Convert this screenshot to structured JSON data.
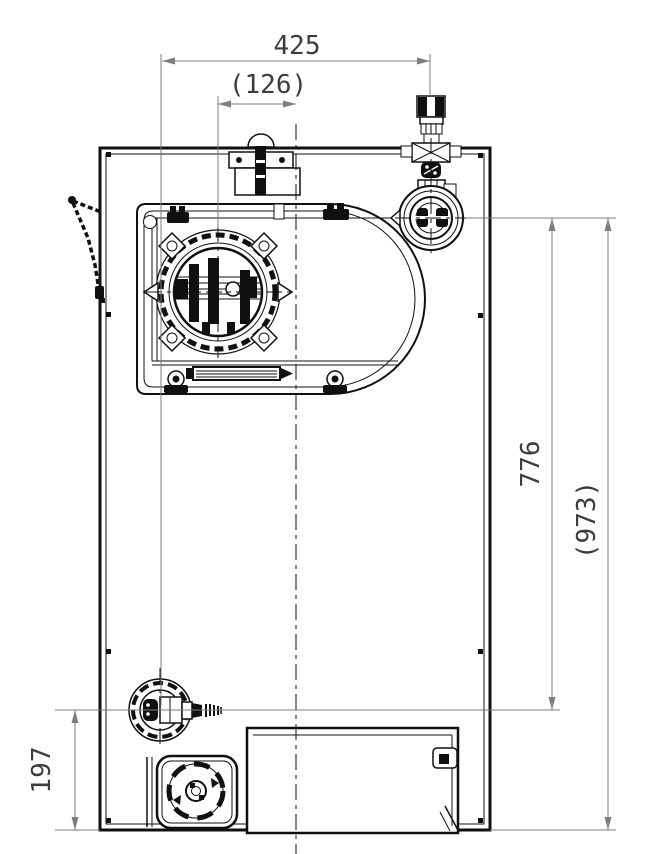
{
  "drawing": {
    "dimensions": {
      "top_width": "425",
      "knob_offset": "(126)",
      "right_height": "776",
      "overall_height": "(973)",
      "bottom_height": "197"
    },
    "colors": {
      "line": "#101010",
      "dim": "#7d7d7d",
      "text": "#3d3d3d",
      "bg": "#ffffff"
    }
  }
}
